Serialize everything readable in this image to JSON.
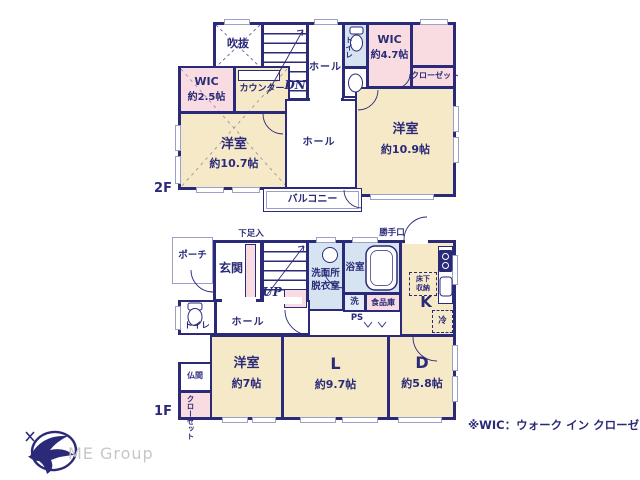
{
  "meta": {
    "note": "※WIC：ウォーク イン クローゼット",
    "logo_text": "ME Group"
  },
  "colors": {
    "wall_navy": "#2a2a78",
    "room_cream": "#f6e9c8",
    "closet_pink": "#f8dce2",
    "wet_area_blue": "#d6e4f1"
  },
  "f2": {
    "floor_label": "2F",
    "void": "吹抜",
    "dn": "DN",
    "hall_top": "ホール",
    "toilet": "トイレ",
    "wic47_name": "WIC",
    "wic47_size": "約4.7帖",
    "closet": "クローゼット",
    "wic25_name": "WIC",
    "wic25_size": "約2.5帖",
    "counter": "カウンター",
    "room_a_name": "洋室",
    "room_a_size": "約10.7帖",
    "hall_mid": "ホール",
    "room_b_name": "洋室",
    "room_b_size": "約10.9帖",
    "balcony": "バルコニー"
  },
  "f1": {
    "floor_label": "1F",
    "porch": "ポーチ",
    "genkan": "玄関",
    "shoe_box": "下足入",
    "up": "UP",
    "washroom_1": "洗面所",
    "washroom_2": "脱衣室",
    "bath": "浴室",
    "back_door": "勝手口",
    "toilet": "トイレ",
    "hall": "ホール",
    "washer": "洗",
    "pantry": "食品庫",
    "ps": "PS",
    "kitchen": "K",
    "underfloor_1": "床下",
    "underfloor_2": "収納",
    "fridge": "冷",
    "butsuma": "仏間",
    "closet": "クローゼット",
    "room_c_name": "洋室",
    "room_c_size": "約7帖",
    "living_name": "L",
    "living_size": "約9.7帖",
    "dining_name": "D",
    "dining_size": "約5.8帖"
  }
}
